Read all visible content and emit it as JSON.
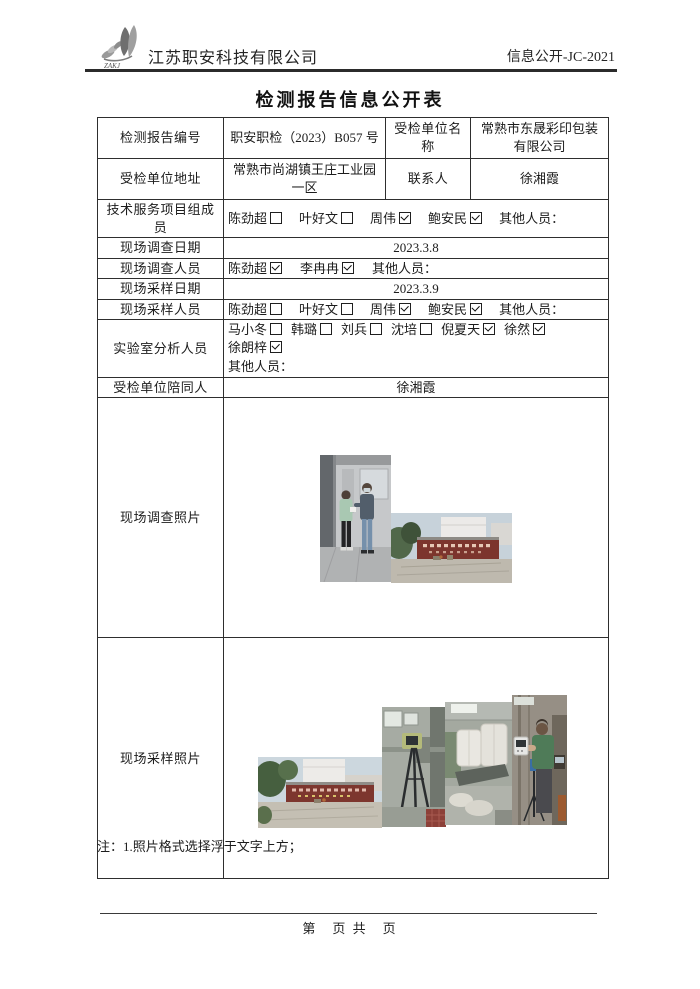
{
  "colors": {
    "text": "#1c1c1c",
    "table_border": "#2e2e2e",
    "gate_sign_red": "#7c352d"
  },
  "header": {
    "logo_text": "ZAKJ",
    "company": "江苏职安科技有限公司",
    "doc_code": "信息公开-JC-2021"
  },
  "title": "检测报告信息公开表",
  "table": {
    "report_no": {
      "label": "检测报告编号",
      "value": "职安职检（2023）B057 号"
    },
    "unit_name": {
      "label": "受检单位名称",
      "value": "常熟市东晟彩印包装有限公司"
    },
    "address": {
      "label": "受检单位地址",
      "value": "常熟市尚湖镇王庄工业园一区"
    },
    "contact": {
      "label": "联系人",
      "value": "徐湘霞"
    },
    "team": {
      "label": "技术服务项目组成员",
      "others": "其他人员：",
      "others_block": false,
      "people": [
        {
          "name": "陈劲超",
          "checked": false
        },
        {
          "name": "叶好文",
          "checked": false
        },
        {
          "name": "周伟",
          "checked": true
        },
        {
          "name": "鲍安民",
          "checked": true
        }
      ]
    },
    "survey_date": {
      "label": "现场调查日期",
      "value": "2023.3.8"
    },
    "survey_staff": {
      "label": "现场调查人员",
      "others": "其他人员：",
      "others_block": false,
      "people": [
        {
          "name": "陈劲超",
          "checked": true
        },
        {
          "name": "李冉冉",
          "checked": true
        }
      ]
    },
    "sampling_date": {
      "label": "现场采样日期",
      "value": "2023.3.9"
    },
    "sampling_staff": {
      "label": "现场采样人员",
      "others": "其他人员：",
      "others_block": false,
      "people": [
        {
          "name": "陈劲超",
          "checked": false
        },
        {
          "name": "叶好文",
          "checked": false
        },
        {
          "name": "周伟",
          "checked": true
        },
        {
          "name": "鲍安民",
          "checked": true
        }
      ]
    },
    "lab_staff": {
      "label": "实验室分析人员",
      "others": "其他人员：",
      "others_block": true,
      "people": [
        {
          "name": "马小冬",
          "checked": false
        },
        {
          "name": "韩璐",
          "checked": false
        },
        {
          "name": "刘兵",
          "checked": false
        },
        {
          "name": "沈培",
          "checked": false
        },
        {
          "name": "倪夏天",
          "checked": true
        },
        {
          "name": "徐然",
          "checked": true
        },
        {
          "name": "徐朗梓",
          "checked": true
        }
      ]
    },
    "accompany": {
      "label": "受检单位陪同人",
      "value": "徐湘霞"
    },
    "survey_photos": {
      "label": "现场调查照片"
    },
    "sampling_photos": {
      "label": "现场采样照片"
    }
  },
  "note": "注：1.照片格式选择浮于文字上方；",
  "footer": {
    "text": "第　页 共　页"
  }
}
